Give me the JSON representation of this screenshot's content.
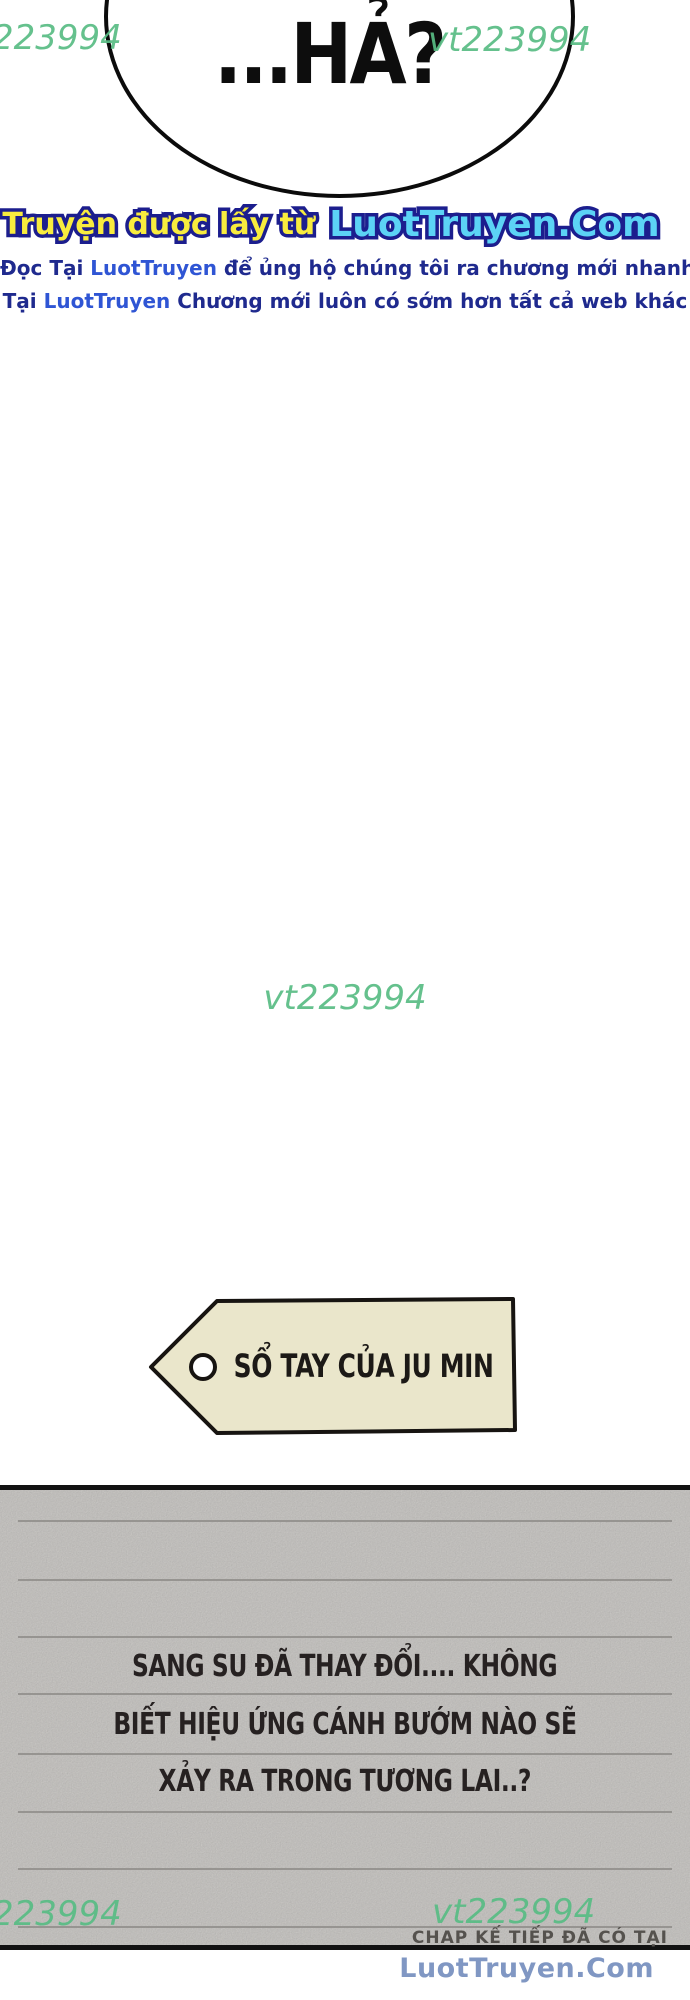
{
  "watermarks": {
    "top_left": "223994",
    "top_right": "vt223994",
    "middle": "vt223994",
    "bottom_left": "223994",
    "bottom_right": "vt223994"
  },
  "bubble": {
    "text": "...HẢ?"
  },
  "branding": {
    "prefix": "Truyện được lấy từ",
    "site": "LuotTruyen.Com"
  },
  "notice": {
    "line1": {
      "pre": "Đọc Tại",
      "site": "LuotTruyen",
      "post": "để ủng hộ chúng tôi ra chương mới nhanh hơn."
    },
    "line2": {
      "pre": "Tại",
      "site": "LuotTruyen",
      "post": "Chương mới luôn có sớm hơn tất cả web khác"
    }
  },
  "tag": {
    "label": "SỔ TAY CỦA JU MIN"
  },
  "notebook": {
    "lines": [
      "SANG SU ĐÃ THAY ĐỔI.... KHÔNG",
      "BIẾT HIỆU ỨNG CÁNH BƯỚM NÀO SẼ",
      "XẢY RA TRONG TƯƠNG LAI..?"
    ]
  },
  "footer": {
    "next_chap": "CHAP KẾ TIẾP ĐÃ CÓ TẠI",
    "site": "LuotTruyen.Com"
  },
  "colors": {
    "watermark_green": "#58bc84",
    "outline_navy": "#1c1e8e",
    "brand_yellow": "#f8ec3e",
    "brand_cyan": "#5cd3f5",
    "notice_navy": "#1f2a8e",
    "notice_link_blue": "#2f55d4",
    "tag_fill": "#eae6cb",
    "notebook_bg": "#d3d1ce",
    "footer_site_blue": "#8097c3"
  }
}
